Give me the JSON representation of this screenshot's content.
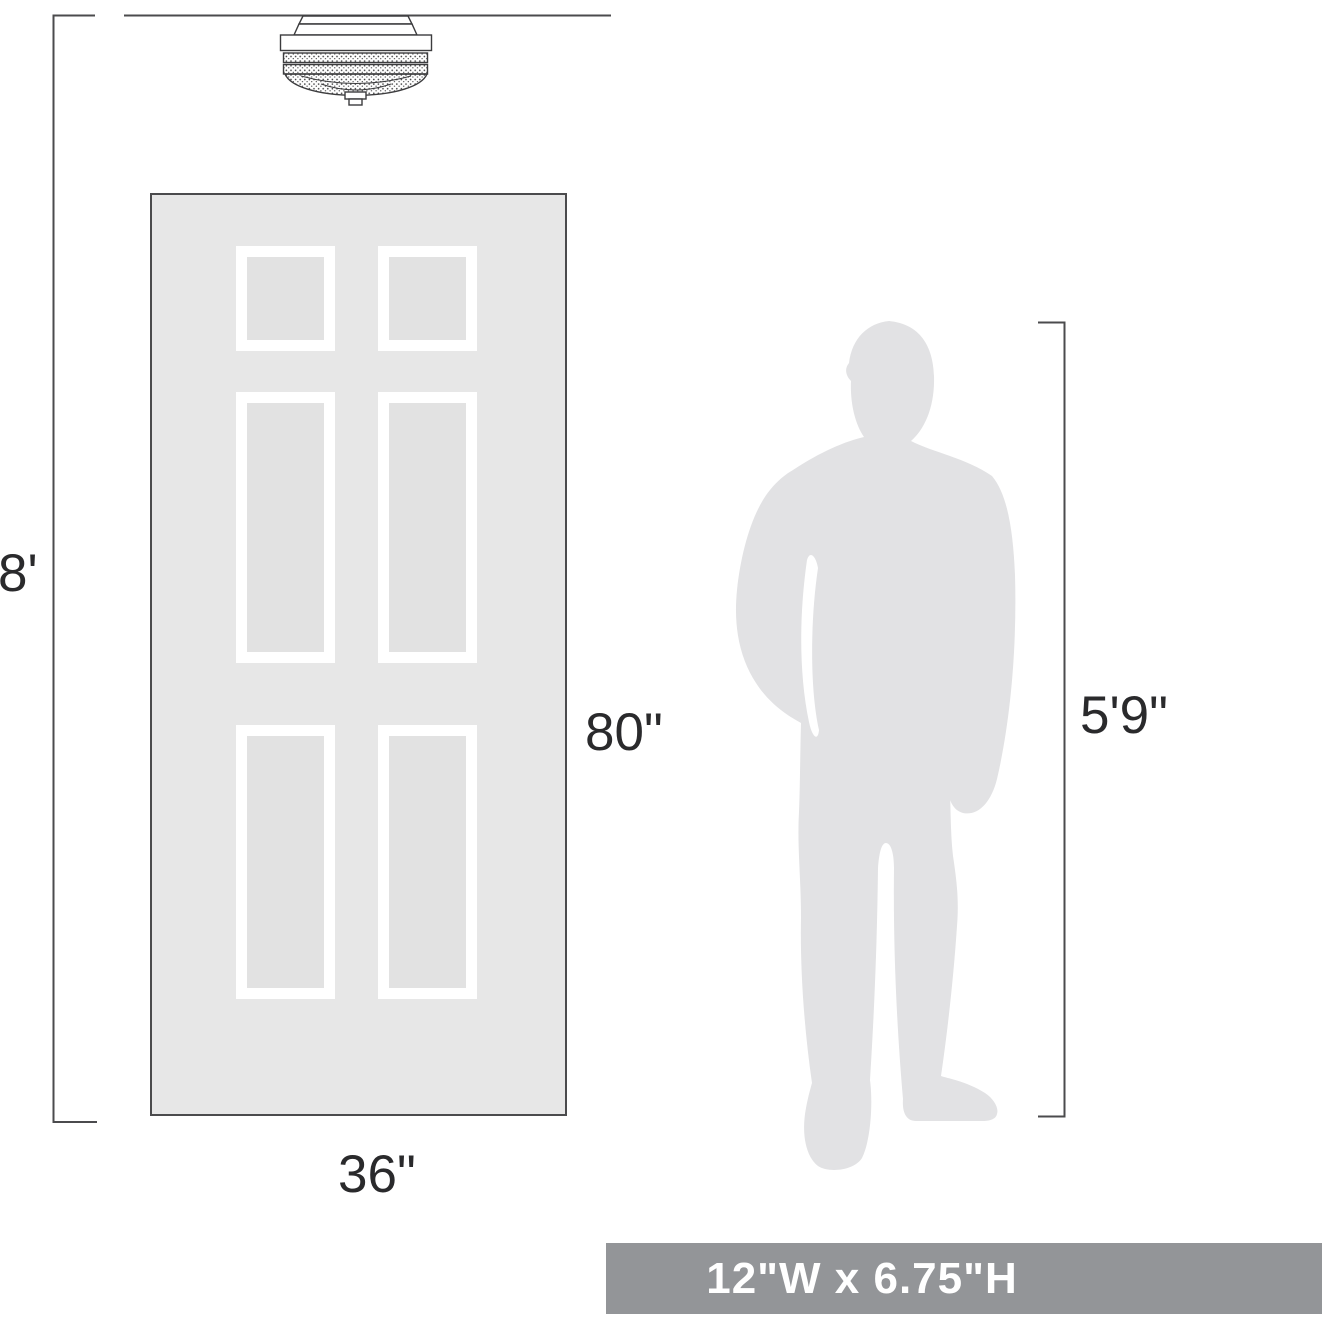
{
  "diagram": {
    "kind": "lighting-fixture-size-comparison",
    "ceiling": {
      "height_label": "8'"
    },
    "fixture": {
      "name": "flush-mount-ceiling-light"
    },
    "door": {
      "width_label": "36\"",
      "height_label": "80\"",
      "panel_count": 6
    },
    "person": {
      "height_label": "5'9\""
    },
    "banner": {
      "text": "12\"W x 6.75\"H"
    },
    "colors": {
      "line": "#4b4b4d",
      "door_fill": "#e7e7e7",
      "door_panel_inner": "#e2e2e2",
      "silhouette": "#e2e2e4",
      "banner_background": "#939598",
      "banner_text": "#ffffff",
      "label_text": "#2a2a2c"
    }
  }
}
